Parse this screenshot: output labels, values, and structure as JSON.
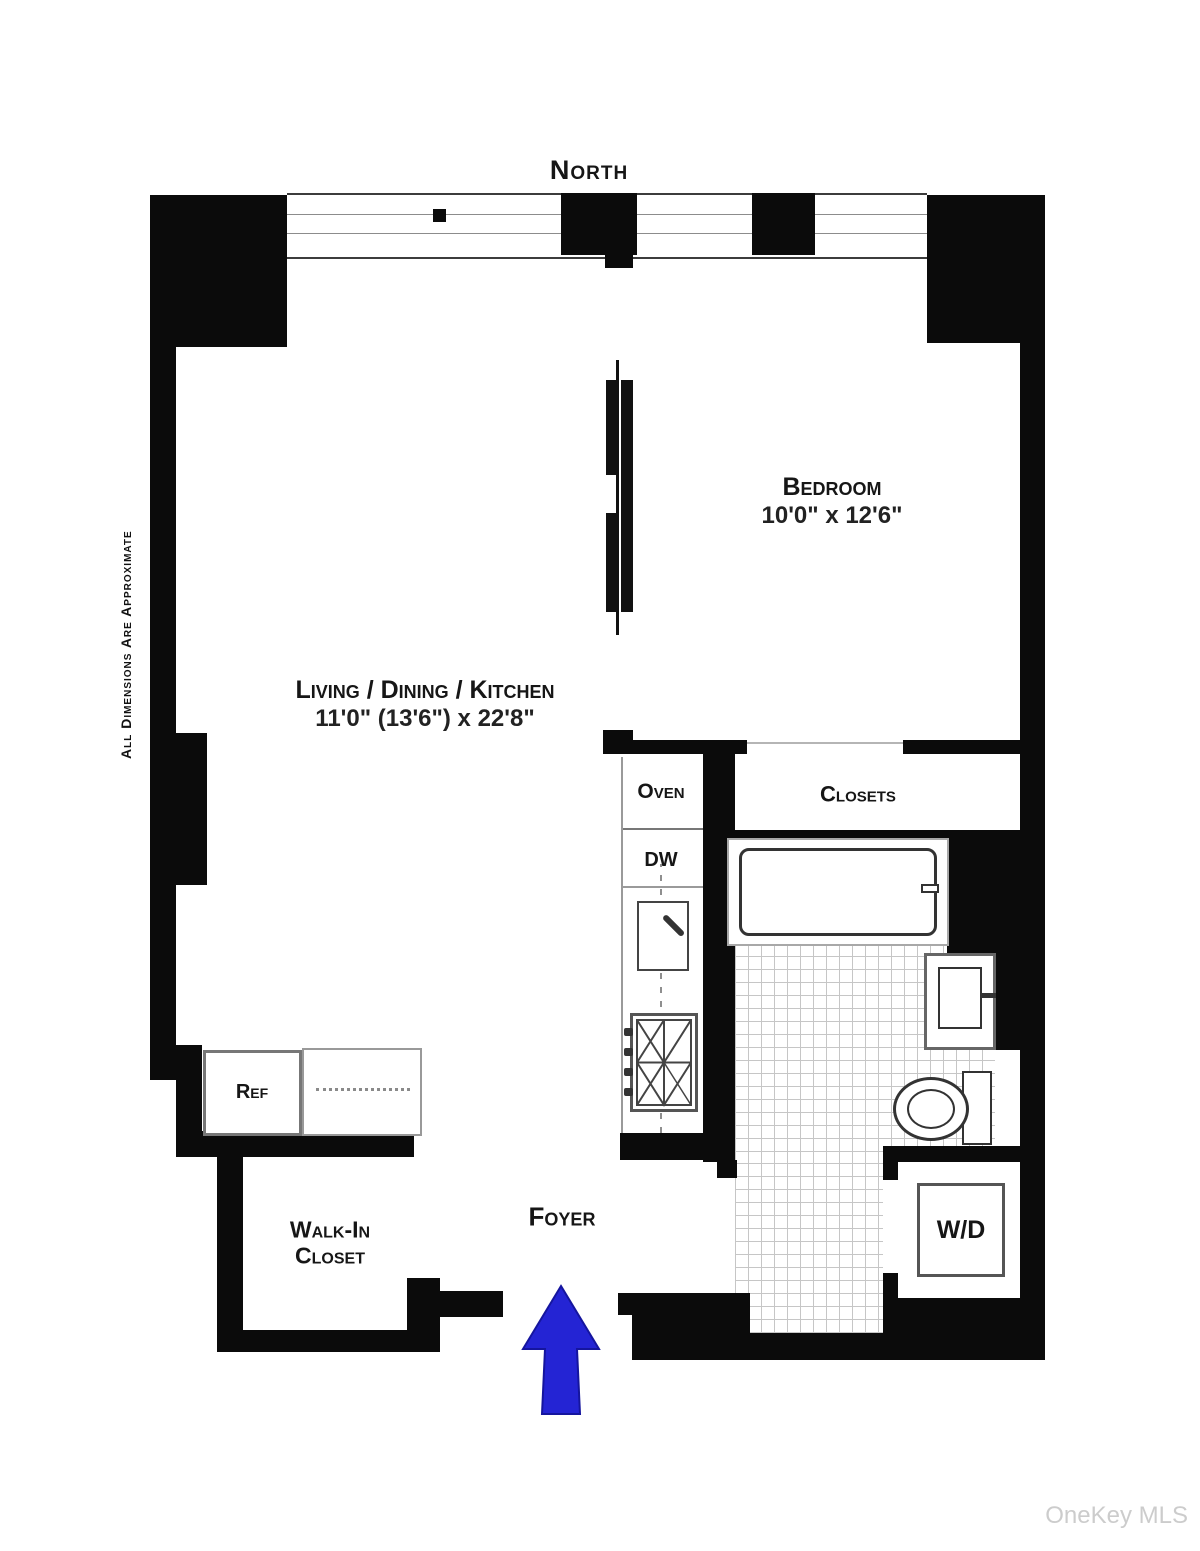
{
  "compass": {
    "north": "North"
  },
  "disclaimer": "All Dimensions Are Approximate",
  "watermark": "OneKey MLS",
  "rooms": {
    "bedroom": {
      "name": "Bedroom",
      "dims": "10'0\" x 12'6\""
    },
    "living": {
      "name": "Living / Dining / Kitchen",
      "dims": "11'0\" (13'6\") x 22'8\""
    },
    "closets": {
      "name": "Closets"
    },
    "walk_in_closet": {
      "line1": "Walk-In",
      "line2": "Closet"
    },
    "foyer": {
      "name": "Foyer"
    }
  },
  "appliances": {
    "oven": "Oven",
    "dishwasher": "DW",
    "refrigerator": "Ref",
    "washer_dryer": "W/D"
  },
  "colors": {
    "wall": "#0b0b0b",
    "entry_arrow": "#2424d4",
    "arrow_outline": "#15159e",
    "watermark": "#cccccc"
  }
}
